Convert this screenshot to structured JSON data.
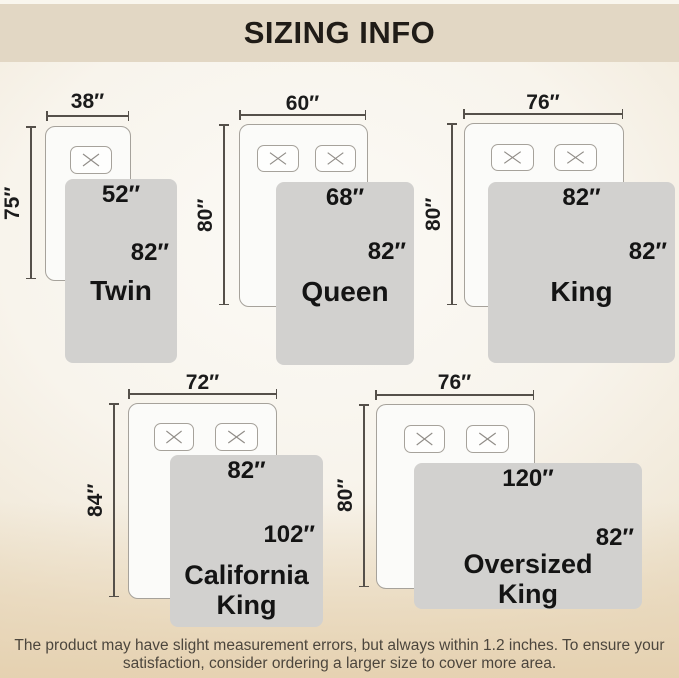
{
  "header": {
    "title": "SIZING INFO"
  },
  "diagrams": [
    {
      "name": "Twin",
      "bed_width": "38″",
      "bed_length": "75″",
      "blanket_width": "52″",
      "blanket_length": "82″",
      "pillows": 1
    },
    {
      "name": "Queen",
      "bed_width": "60″",
      "bed_length": "80″",
      "blanket_width": "68″",
      "blanket_length": "82″",
      "pillows": 2
    },
    {
      "name": "King",
      "bed_width": "76″",
      "bed_length": "80″",
      "blanket_width": "82″",
      "blanket_length": "82″",
      "pillows": 2
    },
    {
      "name": "California King",
      "bed_width": "72″",
      "bed_length": "84″",
      "blanket_width": "82″",
      "blanket_length": "102″",
      "pillows": 2
    },
    {
      "name": "Oversized King",
      "bed_width": "76″",
      "bed_length": "80″",
      "blanket_width": "120″",
      "blanket_length": "82″",
      "pillows": 2
    }
  ],
  "footer": {
    "line1": "The product may have slight measurement errors, but always within 1.2 inches. To ensure your",
    "line2": "satisfaction, consider ordering a larger size to cover more area."
  },
  "colors": {
    "header_bg": "#e2d7c4",
    "blanket_gray": "#d2d1cf",
    "bed_fill": "#fbfbf9",
    "outline": "#a6a29b",
    "dimension_line": "#55504a",
    "label_text": "#141414",
    "footer_text": "#4c463d"
  }
}
